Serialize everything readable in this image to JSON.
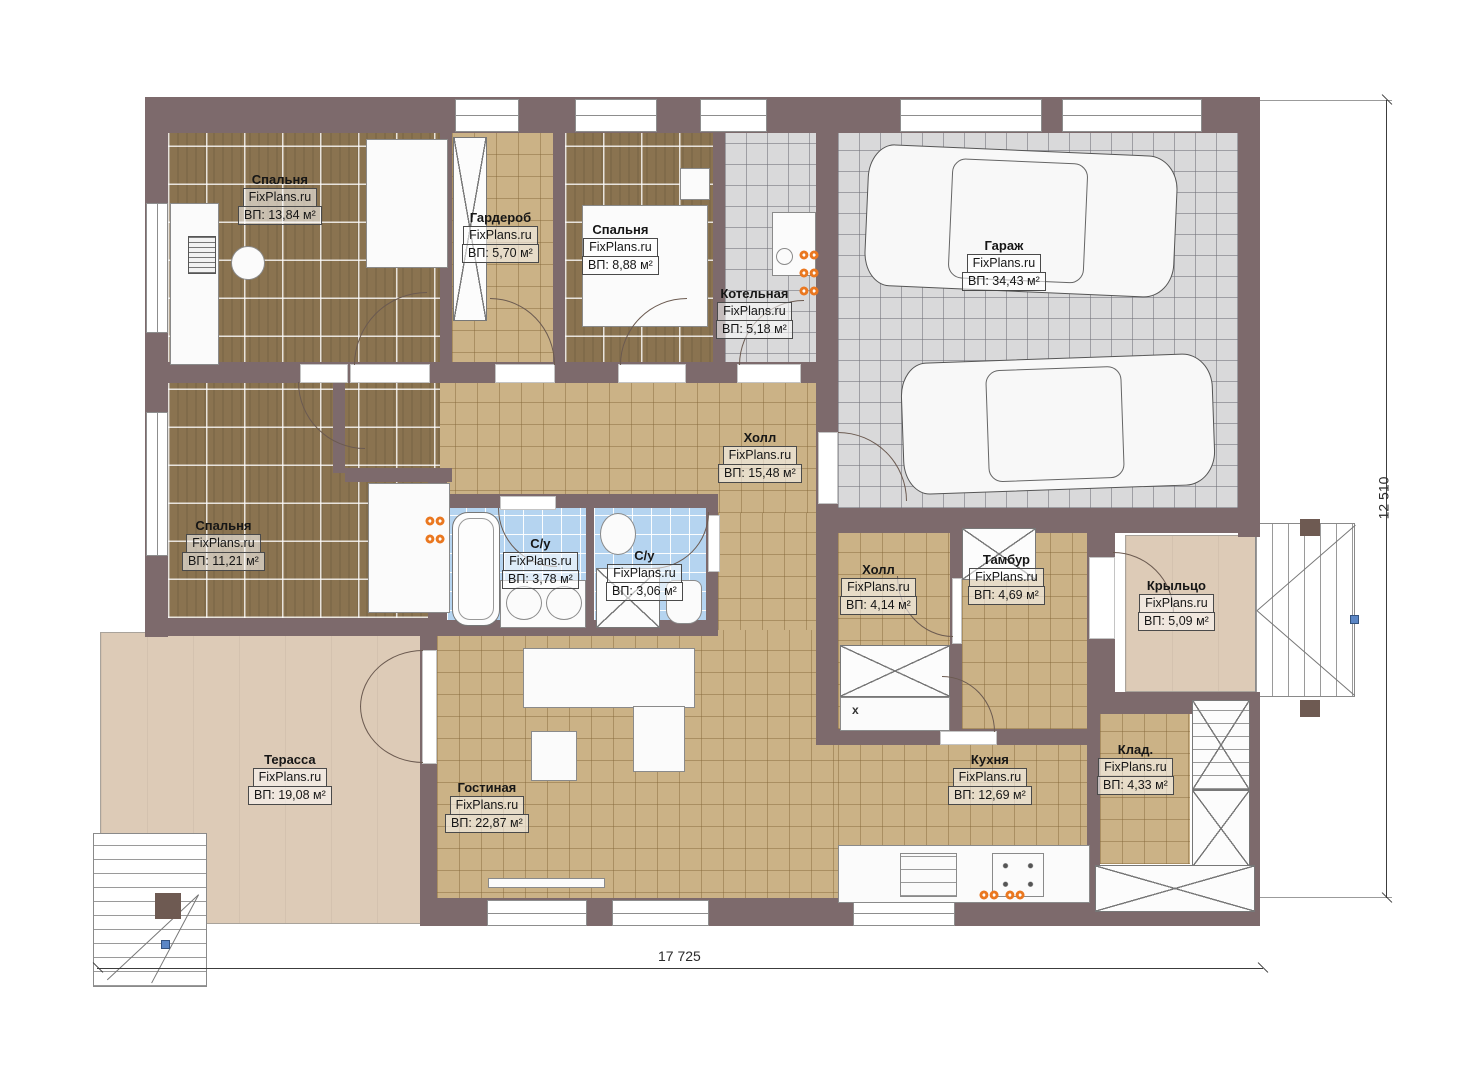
{
  "plan": {
    "watermark": "FixPlans.ru",
    "dimensions": {
      "width_mm": "17 725",
      "height_mm": "12 510"
    },
    "rooms": [
      {
        "name": "Спальня",
        "area": "ВП: 13,84 м²"
      },
      {
        "name": "Гардероб",
        "area": "ВП: 5,70 м²"
      },
      {
        "name": "Спальня",
        "area": "ВП: 8,88 м²"
      },
      {
        "name": "Котельная",
        "area": "ВП: 5,18 м²"
      },
      {
        "name": "Гараж",
        "area": "ВП: 34,43 м²"
      },
      {
        "name": "Холл",
        "area": "ВП: 15,48 м²"
      },
      {
        "name": "Спальня",
        "area": "ВП: 11,21 м²"
      },
      {
        "name": "С/у",
        "area": "ВП: 3,78 м²"
      },
      {
        "name": "С/у",
        "area": "ВП: 3,06 м²"
      },
      {
        "name": "Холл",
        "area": "ВП: 4,14 м²"
      },
      {
        "name": "Тамбур",
        "area": "ВП: 4,69 м²"
      },
      {
        "name": "Крыльцо",
        "area": "ВП: 5,09 м²"
      },
      {
        "name": "Терасса",
        "area": "ВП: 19,08 м²"
      },
      {
        "name": "Гостиная",
        "area": "ВП: 22,87 м²"
      },
      {
        "name": "Кухня",
        "area": "ВП: 12,69 м²"
      },
      {
        "name": "Клад.",
        "area": "ВП: 4,33 м²"
      }
    ],
    "annotations": {
      "cabinet_mark": "x"
    },
    "colors": {
      "wall": "#7d6a6c",
      "floor_wood": "#8a7350",
      "floor_tile_tan": "#cbb286",
      "floor_tile_gray": "#d9d9da",
      "floor_tile_blue": "#b5d4f0",
      "terrace": "#ddcbb7",
      "radiator_orange": "#ea7821",
      "marker_blue": "#5b86c5"
    }
  }
}
